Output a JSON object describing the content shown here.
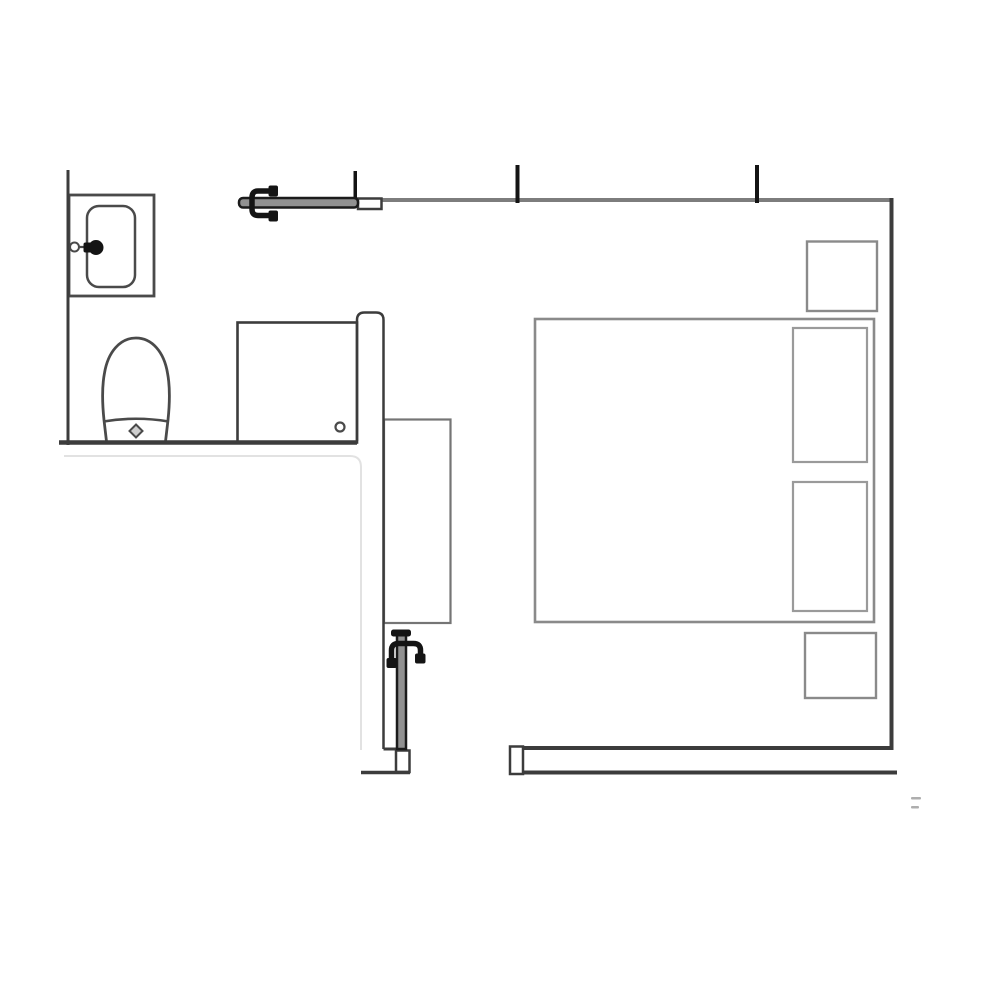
{
  "page": {
    "title": "Bedroom with en-suite bathroom floor plan",
    "background": "#ffffff"
  },
  "colors": {
    "wall": "#3c3c3c",
    "wall_light": "#7d7d7d",
    "fixture": "#4a4a4a",
    "furniture": "#8a8a8a",
    "furniture_light": "#9a9a9a",
    "wardrobe_line": "#757575",
    "door_fill": "#919191",
    "door_edge": "#1b1b1b",
    "hinge": "#141414",
    "ghost": "#e2e2e2",
    "drain_fill": "#cfcfcf",
    "artifact": "#aeaeae",
    "paper": "#ffffff"
  },
  "plan": {
    "rooms": [
      {
        "name": "bathroom"
      },
      {
        "name": "bedroom"
      }
    ],
    "fixtures": [
      {
        "name": "sink"
      },
      {
        "name": "toilet"
      },
      {
        "name": "shower-cabin"
      },
      {
        "name": "wardrobe"
      },
      {
        "name": "double-bed"
      },
      {
        "name": "pillow-top"
      },
      {
        "name": "pillow-bottom"
      },
      {
        "name": "nightstand-top"
      },
      {
        "name": "nightstand-bottom"
      },
      {
        "name": "entry-door"
      },
      {
        "name": "bathroom-door"
      }
    ]
  }
}
